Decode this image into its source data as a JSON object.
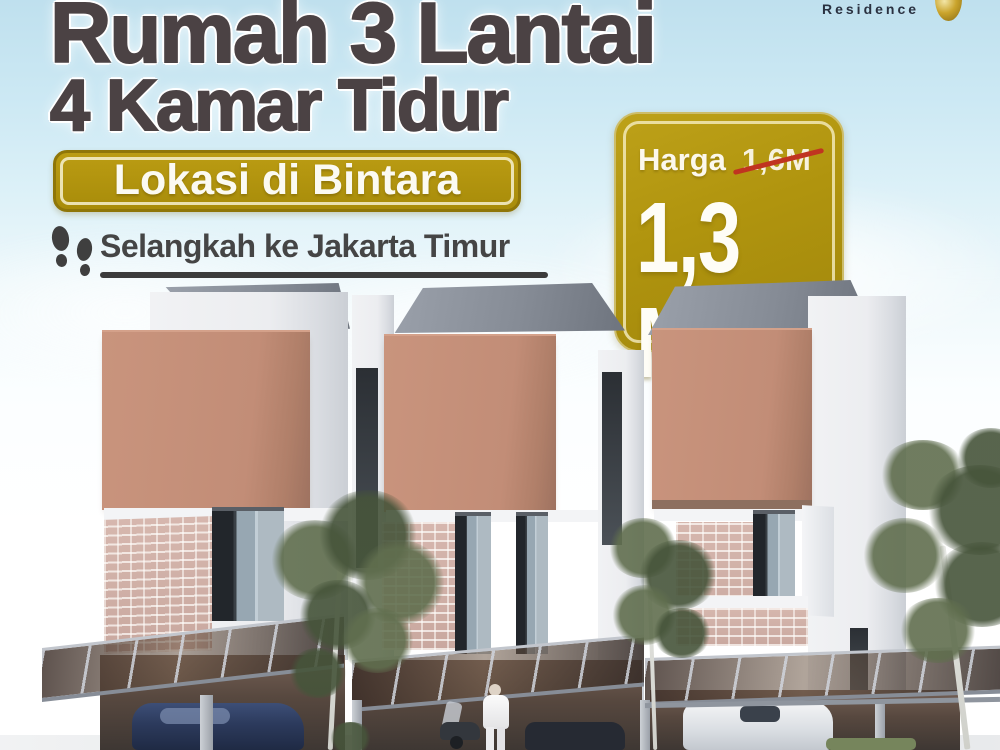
{
  "brand": {
    "name": "Residence",
    "mark_icon": "gold-sphere"
  },
  "headline": {
    "line1": "Rumah 3 Lantai",
    "line2": "4 Kamar Tidur"
  },
  "location_badge": {
    "label": "Lokasi di Bintara"
  },
  "tagline": {
    "icon": "footsteps",
    "text": "Selangkah ke Jakarta Timur"
  },
  "price_sign": {
    "label": "Harga",
    "old_price": "1,6M",
    "new_price": "1,3 M"
  },
  "scene_description": "3D render of three modern three-storey terraced houses with terracotta facade panels, glass carport canopies, parked cars, a scooter, a person in white and young trees",
  "colors": {
    "gold": "#b2930e",
    "gold_inner_border": "#eee3a5",
    "headline_text": "#4b4244",
    "tagline_text": "#454545",
    "strike_red": "#c03420",
    "terracotta": "#c28d77",
    "roof_gray": "#868c96",
    "sky_blue": "#c7e5f0"
  }
}
